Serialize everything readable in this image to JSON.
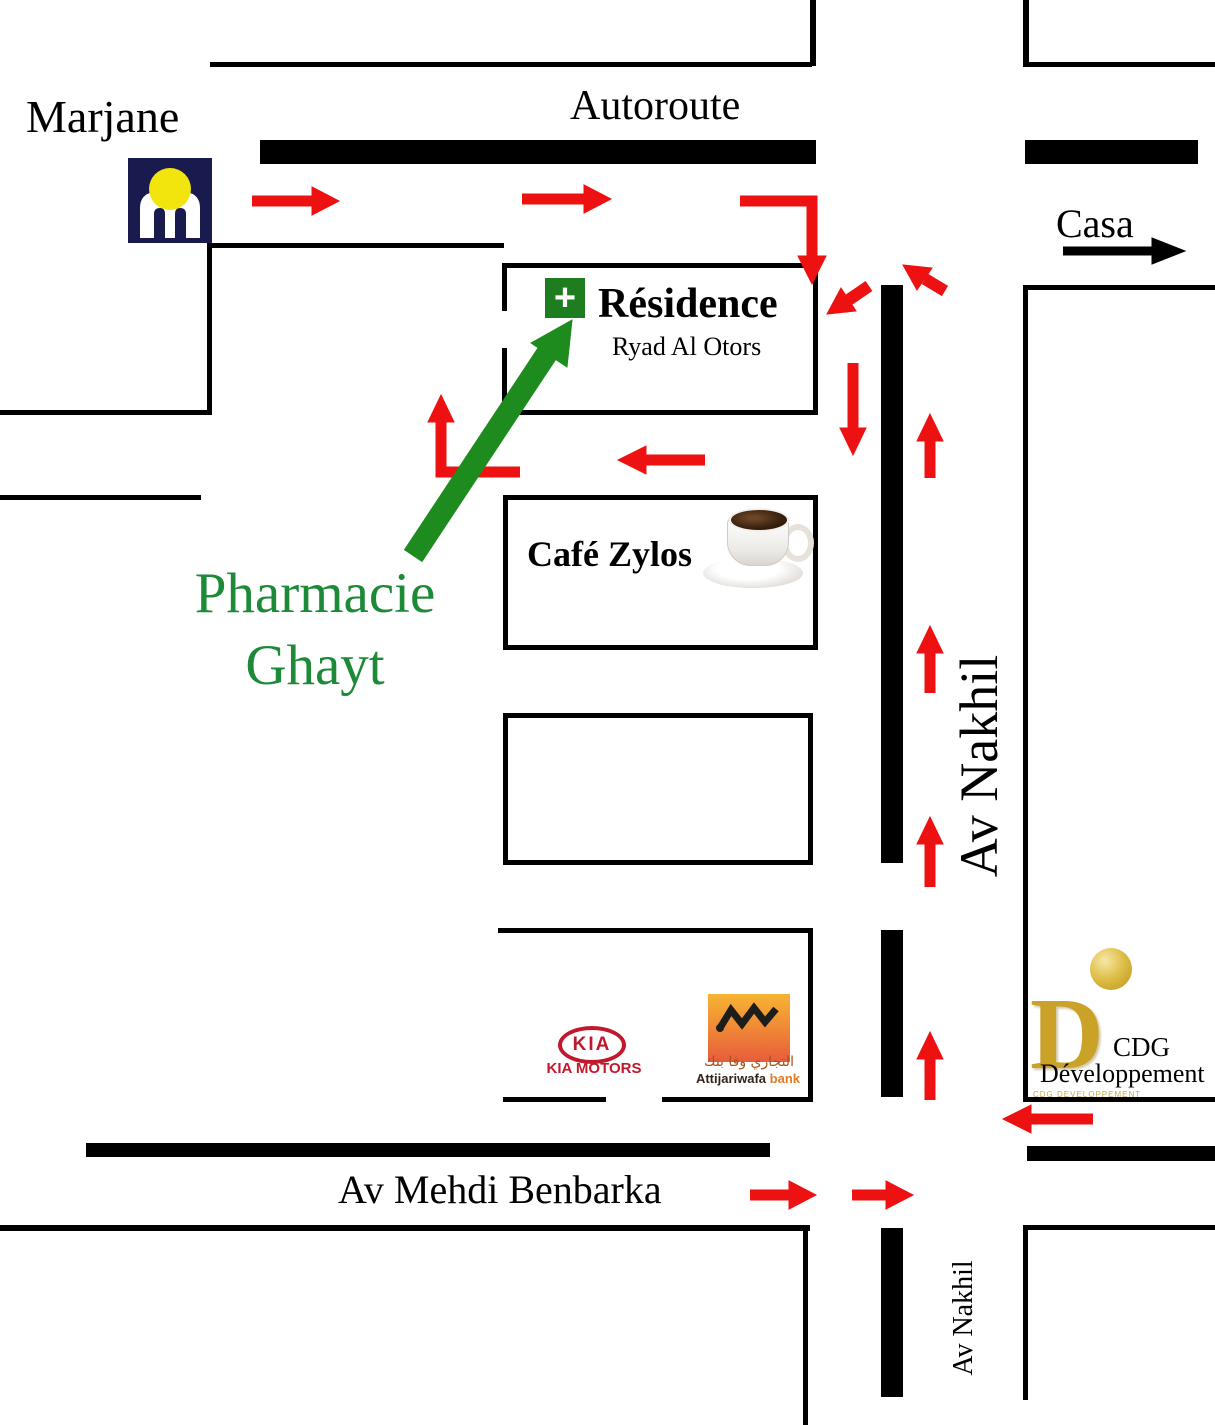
{
  "places": {
    "marjane": "Marjane",
    "residence": {
      "plus": "+",
      "title": "Résidence",
      "subtitle": "Ryad Al Otors"
    },
    "cafe": "Café Zylos",
    "pharmacy": {
      "line1": "Pharmacie",
      "line2": "Ghayt"
    },
    "kia": {
      "oval": "KIA",
      "caption": "KIA MOTORS"
    },
    "attijariwafa": {
      "arabic": "التجاري وفا بنك",
      "name": "Attijariwafa",
      "bank": "bank"
    },
    "cdg": {
      "letter": "D",
      "fine_print": "CDG DEVELOPPEMENT",
      "line1": "CDG",
      "line2": "Développement"
    }
  },
  "roads": {
    "autoroute": "Autoroute",
    "av_nakhil": "Av Nakhil",
    "av_nakhil_bottom": "Av Nakhil",
    "av_mehdi_benbarka": "Av Mehdi Benbarka"
  },
  "directions": {
    "casa": "Casa"
  },
  "colors": {
    "arrow_red": "#ee1111",
    "arrow_green": "#1e8b1e",
    "pharmacy_green": "#1d8a38",
    "plus_green": "#1e7d1f",
    "marjane_navy": "#191b4f",
    "marjane_yellow": "#f2e50e",
    "road_black": "#000000",
    "kia_red": "#c2182b",
    "awb_orange_top": "#f7b433",
    "awb_orange_bottom": "#e85c3c",
    "cdg_gold": "#c9a227"
  }
}
